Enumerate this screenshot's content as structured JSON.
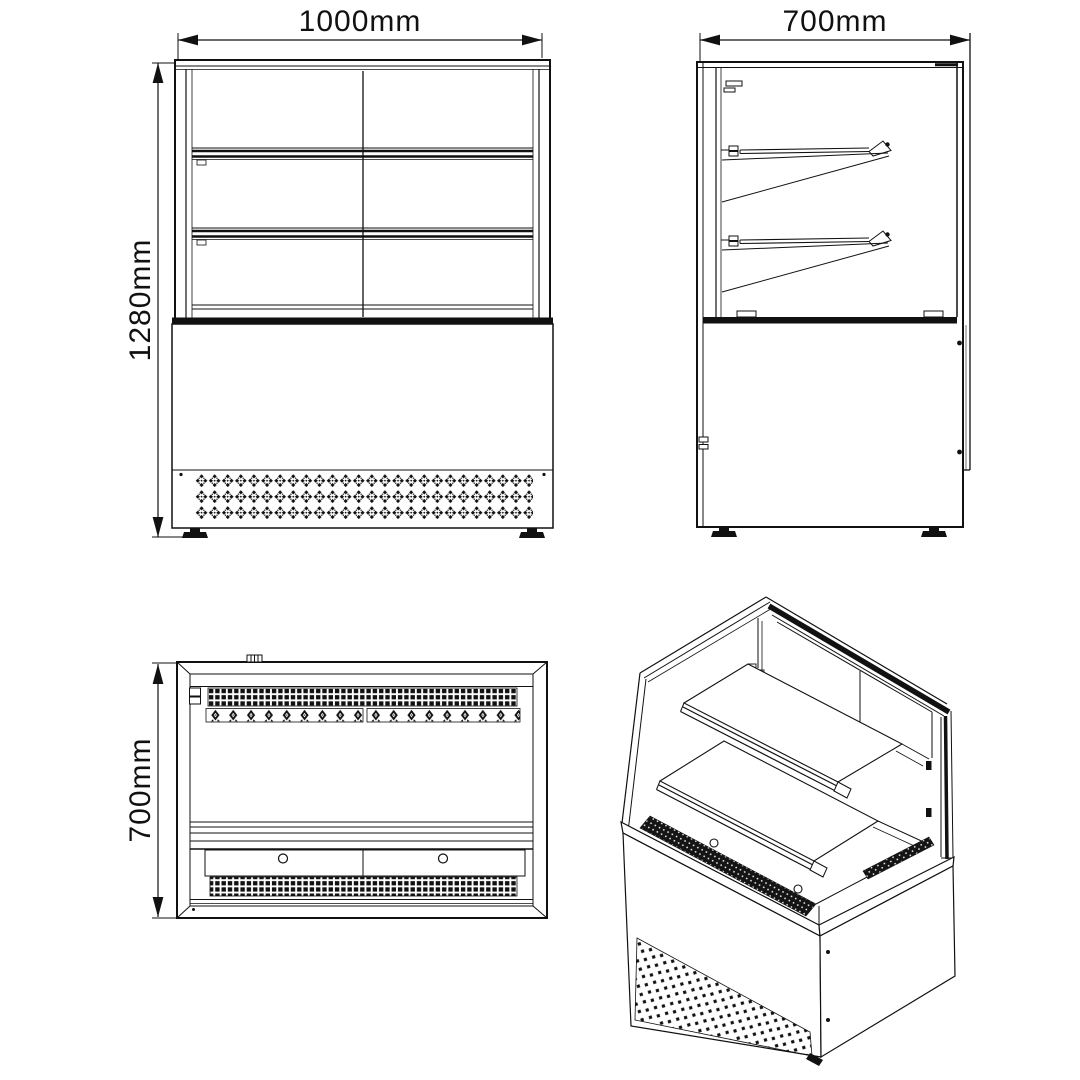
{
  "page": {
    "background": "#ffffff",
    "line_color": "#111111"
  },
  "dimensions": {
    "front": {
      "width": "1000mm",
      "height": "1280mm"
    },
    "side": {
      "depth": "700mm"
    },
    "top": {
      "depth": "700mm"
    }
  }
}
